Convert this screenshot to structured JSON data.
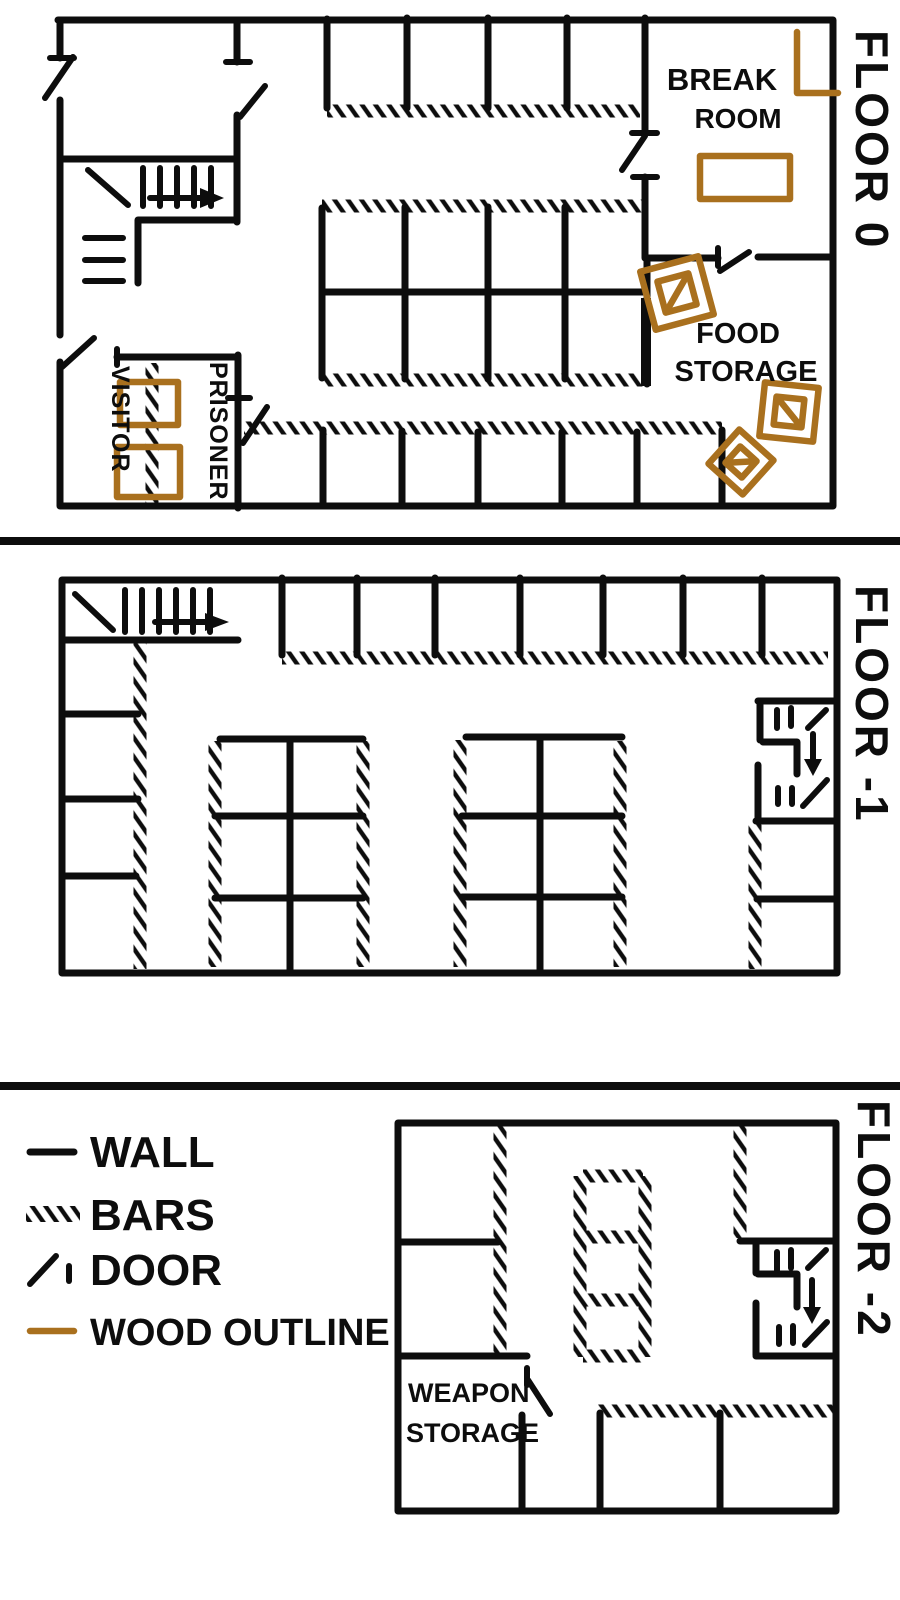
{
  "palette": {
    "ink": "#0d0d0d",
    "wood": "#a9701e",
    "paper": "#ffffff"
  },
  "floors": [
    {
      "id": "floor-0",
      "label": "FLOOR 0",
      "rooms": {
        "break_room": {
          "line1": "BREAK",
          "line2": "ROOM"
        },
        "food_storage": {
          "line1": "FOOD",
          "line2": "STORAGE"
        },
        "visitor": "VISITOR",
        "prisoner": "PRISONER"
      }
    },
    {
      "id": "floor-minus-1",
      "label": "FLOOR -1"
    },
    {
      "id": "floor-minus-2",
      "label": "FLOOR -2",
      "rooms": {
        "weapon_storage": {
          "line1": "WEAPON",
          "line2": "STORAGE"
        }
      }
    }
  ],
  "legend": {
    "items": [
      {
        "key": "wall",
        "label": "WALL"
      },
      {
        "key": "bars",
        "label": "BARS"
      },
      {
        "key": "door",
        "label": "DOOR"
      },
      {
        "key": "wood",
        "label": "WOOD OUTLINE"
      }
    ]
  }
}
